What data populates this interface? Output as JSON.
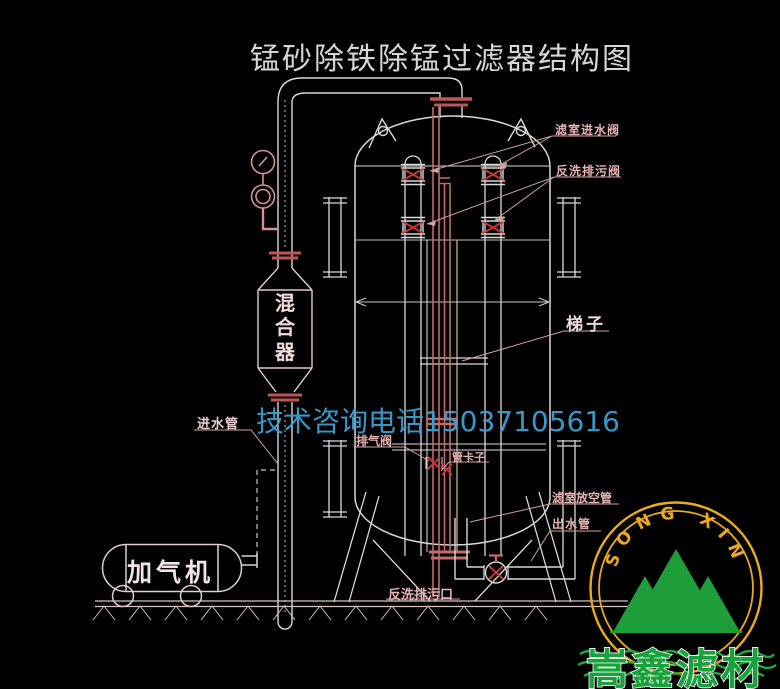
{
  "title": "锰砂除铁除锰过滤器结构图",
  "watermark": "技术咨询电话15037105616",
  "labels": {
    "filter_inlet_valve": "滤室进水阀",
    "backwash_drain_valve": "反洗排污阀",
    "ladder": "梯子",
    "mixer": "混合器",
    "inlet_pipe": "进水管",
    "exhaust_valve": "排气阀",
    "pipe_clamp": "管卡子",
    "chamber_vent_pipe": "滤室放空管",
    "outlet_pipe": "出水管",
    "backwash_drain_port": "反洗排污口",
    "aerator": "加气机"
  },
  "logo": {
    "ring_text": "SONG XIN",
    "company": "嵩鑫滤材",
    "ring_color": "#eaa91e",
    "mountain_color": "#1e9e38",
    "company_text_color": "#17a33c"
  },
  "colors": {
    "background": "#000000",
    "line": "#d9d9d9",
    "pipe_red": "#c46a6a",
    "valve_red": "#c43838",
    "label_pink": "#e8b2b2",
    "watermark_blue": "#3aa0d4"
  }
}
